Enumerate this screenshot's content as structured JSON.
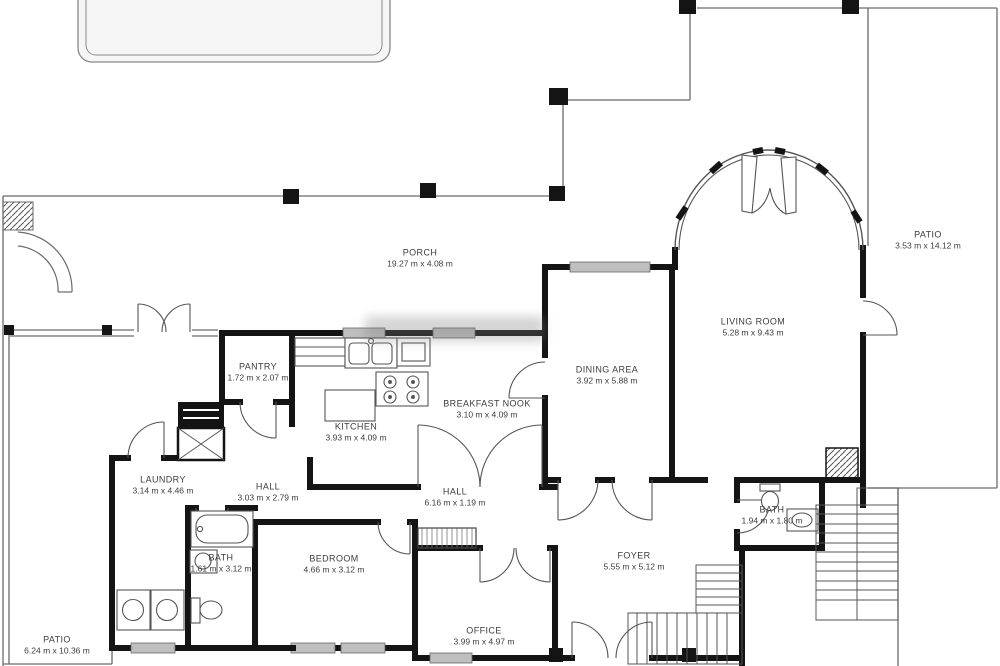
{
  "plan": {
    "type": "residential-floor-plan",
    "units": "m",
    "colors": {
      "wall": "#141414",
      "thin_line": "#6a6a6a",
      "window_fill": "#bfbfbf",
      "label_text": "#3d3d3d",
      "pool_fill": "#f6f6f6",
      "background": "#ffffff"
    },
    "rooms": [
      {
        "id": "porch",
        "name": "PORCH",
        "dims": "19.27 m x 4.08 m"
      },
      {
        "id": "patio-right",
        "name": "PATIO",
        "dims": "3.53 m x 14.12 m"
      },
      {
        "id": "living-room",
        "name": "LIVING ROOM",
        "dims": "5.28 m x 9.43 m"
      },
      {
        "id": "dining-area",
        "name": "DINING AREA",
        "dims": "3.92 m x 5.88 m"
      },
      {
        "id": "breakfast-nook",
        "name": "BREAKFAST NOOK",
        "dims": "3.10 m x 4.09 m"
      },
      {
        "id": "kitchen",
        "name": "KITCHEN",
        "dims": "3.93 m x 4.09 m"
      },
      {
        "id": "pantry",
        "name": "PANTRY",
        "dims": "1.72 m x 2.07 m"
      },
      {
        "id": "laundry",
        "name": "LAUNDRY",
        "dims": "3.14 m x 4.46 m"
      },
      {
        "id": "hall-1",
        "name": "HALL",
        "dims": "3.03 m x 2.79 m"
      },
      {
        "id": "hall-2",
        "name": "HALL",
        "dims": "6.16 m x 1.19 m"
      },
      {
        "id": "bath-right",
        "name": "BATH",
        "dims": "1.94 m x 1.80 m"
      },
      {
        "id": "foyer",
        "name": "FOYER",
        "dims": "5.55 m x 5.12 m"
      },
      {
        "id": "bedroom",
        "name": "BEDROOM",
        "dims": "4.66 m x 3.12 m"
      },
      {
        "id": "bath-left",
        "name": "BATH",
        "dims": "1.61 m x 3.12 m"
      },
      {
        "id": "office",
        "name": "OFFICE",
        "dims": "3.99 m x 4.97 m"
      },
      {
        "id": "patio-left",
        "name": "PATIO",
        "dims": "6.24 m x 10.36 m"
      }
    ]
  }
}
